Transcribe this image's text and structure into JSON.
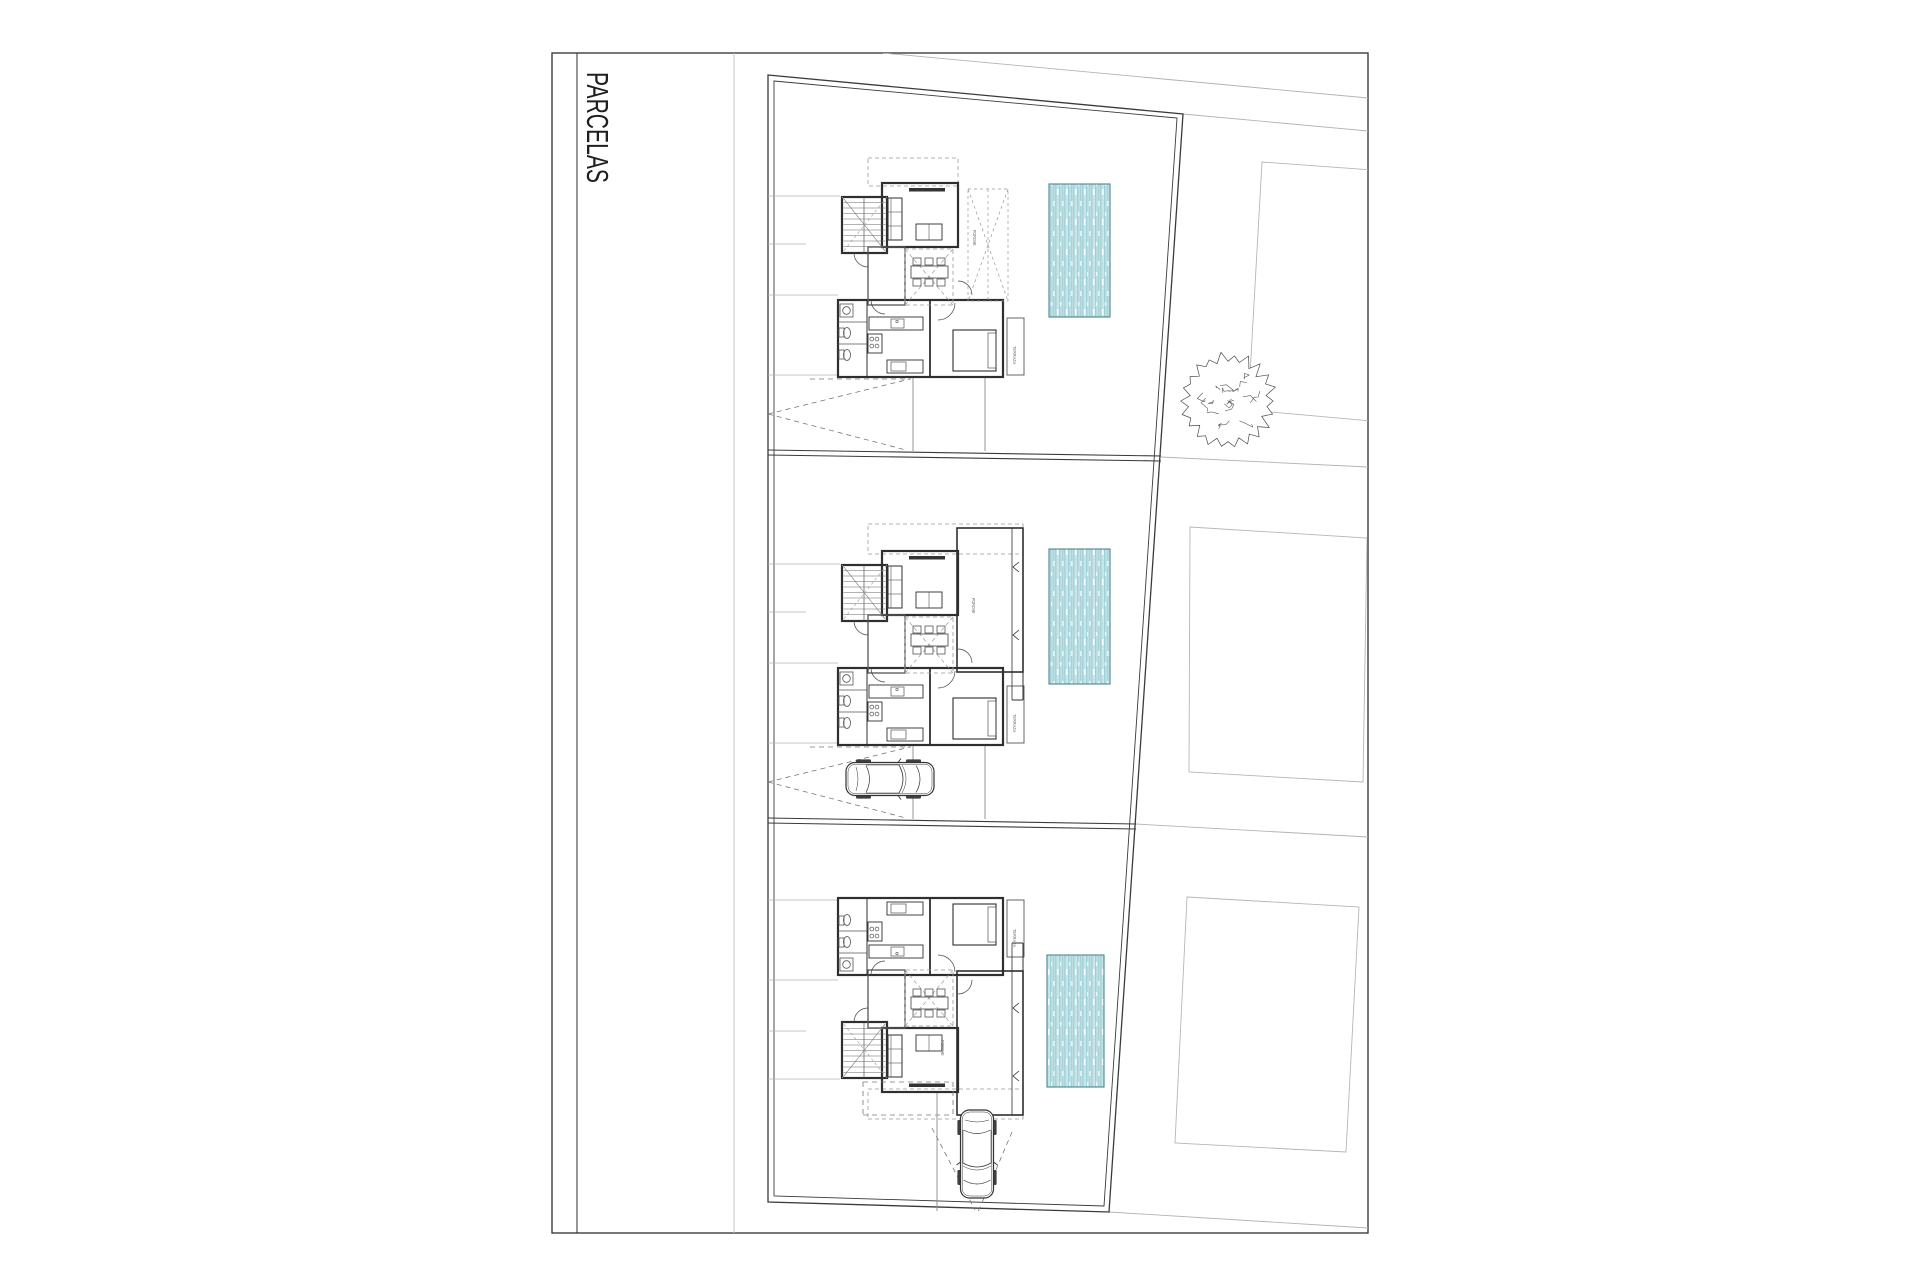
{
  "sheet": {
    "title": "PARCELAS",
    "frame": {
      "x": 552,
      "y": 53,
      "w": 816,
      "h": 1180
    },
    "title_divider_x": 577,
    "margin_line_x": 734
  },
  "colors": {
    "frame": "#2e2e2e",
    "wall": "#2f2f2f",
    "line_medium": "#555555",
    "line_light": "#b3b3b3",
    "dash": "#999999",
    "drive_dash": "#777777",
    "pool_border": "#4d868e",
    "pool_bg": "#d9edef",
    "pool_stripes": [
      "#a6d4da",
      "#6fb4be",
      "#c2e3e7",
      "#8cc6cf",
      "#b3dce1"
    ],
    "tree": "#4a4a4a",
    "car": "#333333",
    "title_text": "#1f1f1f",
    "label_text": "#666666"
  },
  "site": {
    "outer": [
      [
        768,
        75
      ],
      [
        1183,
        114
      ],
      [
        1109,
        1212
      ],
      [
        768,
        1202
      ]
    ],
    "inner": [
      [
        774,
        81
      ],
      [
        1177,
        118
      ],
      [
        1104,
        1206
      ],
      [
        774,
        1196
      ]
    ],
    "dividers": [
      {
        "lines": [
          [
            768,
            450,
            1161,
            456
          ],
          [
            768,
            455,
            1161,
            461
          ]
        ]
      },
      {
        "lines": [
          [
            768,
            818,
            1136,
            824
          ],
          [
            768,
            823,
            1136,
            829
          ]
        ]
      }
    ],
    "light_lines": [
      [
        883,
        53,
        1368,
        98
      ],
      [
        1183,
        114,
        1368,
        131
      ],
      [
        1109,
        1212,
        1368,
        1228
      ],
      [
        1161,
        457,
        1368,
        467
      ],
      [
        1136,
        824,
        1368,
        837
      ]
    ]
  },
  "neighbors": [
    [
      [
        1262,
        162
      ],
      [
        1372,
        170
      ],
      [
        1372,
        421
      ],
      [
        1248,
        410
      ]
    ],
    [
      [
        1190,
        527
      ],
      [
        1367,
        538
      ],
      [
        1363,
        782
      ],
      [
        1189,
        772
      ]
    ],
    [
      [
        1187,
        897
      ],
      [
        1359,
        907
      ],
      [
        1346,
        1152
      ],
      [
        1175,
        1143
      ]
    ]
  ],
  "tree": {
    "cx": 1228,
    "cy": 401,
    "r": 46
  },
  "pools": [
    {
      "name": "pool-1",
      "x": 1049,
      "y": 184,
      "w": 61,
      "h": 133
    },
    {
      "name": "pool-2",
      "x": 1049,
      "y": 549,
      "w": 61,
      "h": 135
    },
    {
      "name": "pool-3",
      "x": 1047,
      "y": 955,
      "w": 57,
      "h": 132
    }
  ],
  "houses": [
    {
      "name": "house-1",
      "dy": 0,
      "mirror": false,
      "porch": "dashed"
    },
    {
      "name": "house-2",
      "dy": 368,
      "mirror": false,
      "porch": "walled"
    },
    {
      "name": "house-3",
      "dy": 0,
      "mirror": true,
      "mirror_y": 1275,
      "porch": "walled"
    }
  ],
  "house_labels": [
    {
      "text": "PORCHE",
      "x": 973,
      "y": 230
    },
    {
      "text": "TERRAZA",
      "x": 1013,
      "y": 346
    },
    {
      "text": "PORCHE",
      "x": 972,
      "y": 598
    },
    {
      "text": "TERRAZA",
      "x": 1013,
      "y": 714
    },
    {
      "text": "PORCHE",
      "x": 941,
      "y": 1040
    },
    {
      "text": "TERRAZA",
      "x": 1013,
      "y": 929
    }
  ],
  "patio_lines": [
    [
      768,
      196,
      840,
      196
    ],
    [
      768,
      244,
      806,
      244
    ],
    [
      768,
      295,
      838,
      295
    ],
    [
      768,
      375,
      838,
      375
    ],
    [
      768,
      564,
      840,
      564
    ],
    [
      768,
      612,
      806,
      612
    ],
    [
      768,
      663,
      838,
      663
    ],
    [
      768,
      743,
      838,
      743
    ],
    [
      768,
      1079,
      840,
      1079
    ],
    [
      768,
      1031,
      806,
      1031
    ],
    [
      768,
      980,
      838,
      980
    ],
    [
      768,
      900,
      838,
      900
    ]
  ],
  "driveways": [
    {
      "name": "driveway-1",
      "dash": [
        [
          768,
          414,
          910,
          379
        ],
        [
          768,
          414,
          906,
          450
        ],
        [
          810,
          379,
          911,
          379
        ]
      ],
      "solid": [
        [
          913,
          378,
          913,
          451
        ],
        [
          985,
          378,
          985,
          451
        ]
      ]
    },
    {
      "name": "driveway-2",
      "dash": [
        [
          768,
          782,
          910,
          747
        ],
        [
          768,
          782,
          906,
          818
        ],
        [
          810,
          747,
          911,
          747
        ]
      ],
      "solid": [
        [
          913,
          746,
          913,
          819
        ],
        [
          985,
          746,
          985,
          819
        ]
      ]
    },
    {
      "name": "driveway-3",
      "dash": [
        [
          932,
          1128,
          975,
          1210
        ],
        [
          1012,
          1132,
          978,
          1212
        ],
        [
          863,
          1082,
          953,
          1082
        ],
        [
          863,
          1115,
          953,
          1115
        ],
        [
          863,
          1082,
          863,
          1115
        ],
        [
          953,
          1082,
          953,
          1115
        ]
      ],
      "solid": [
        [
          937,
          1093,
          937,
          1211
        ]
      ]
    }
  ],
  "cars": [
    {
      "name": "car-middle",
      "cx": 890,
      "cy": 779,
      "rotate": 0
    },
    {
      "name": "car-bottom",
      "cx": 977,
      "cy": 1154,
      "rotate": 90
    }
  ]
}
